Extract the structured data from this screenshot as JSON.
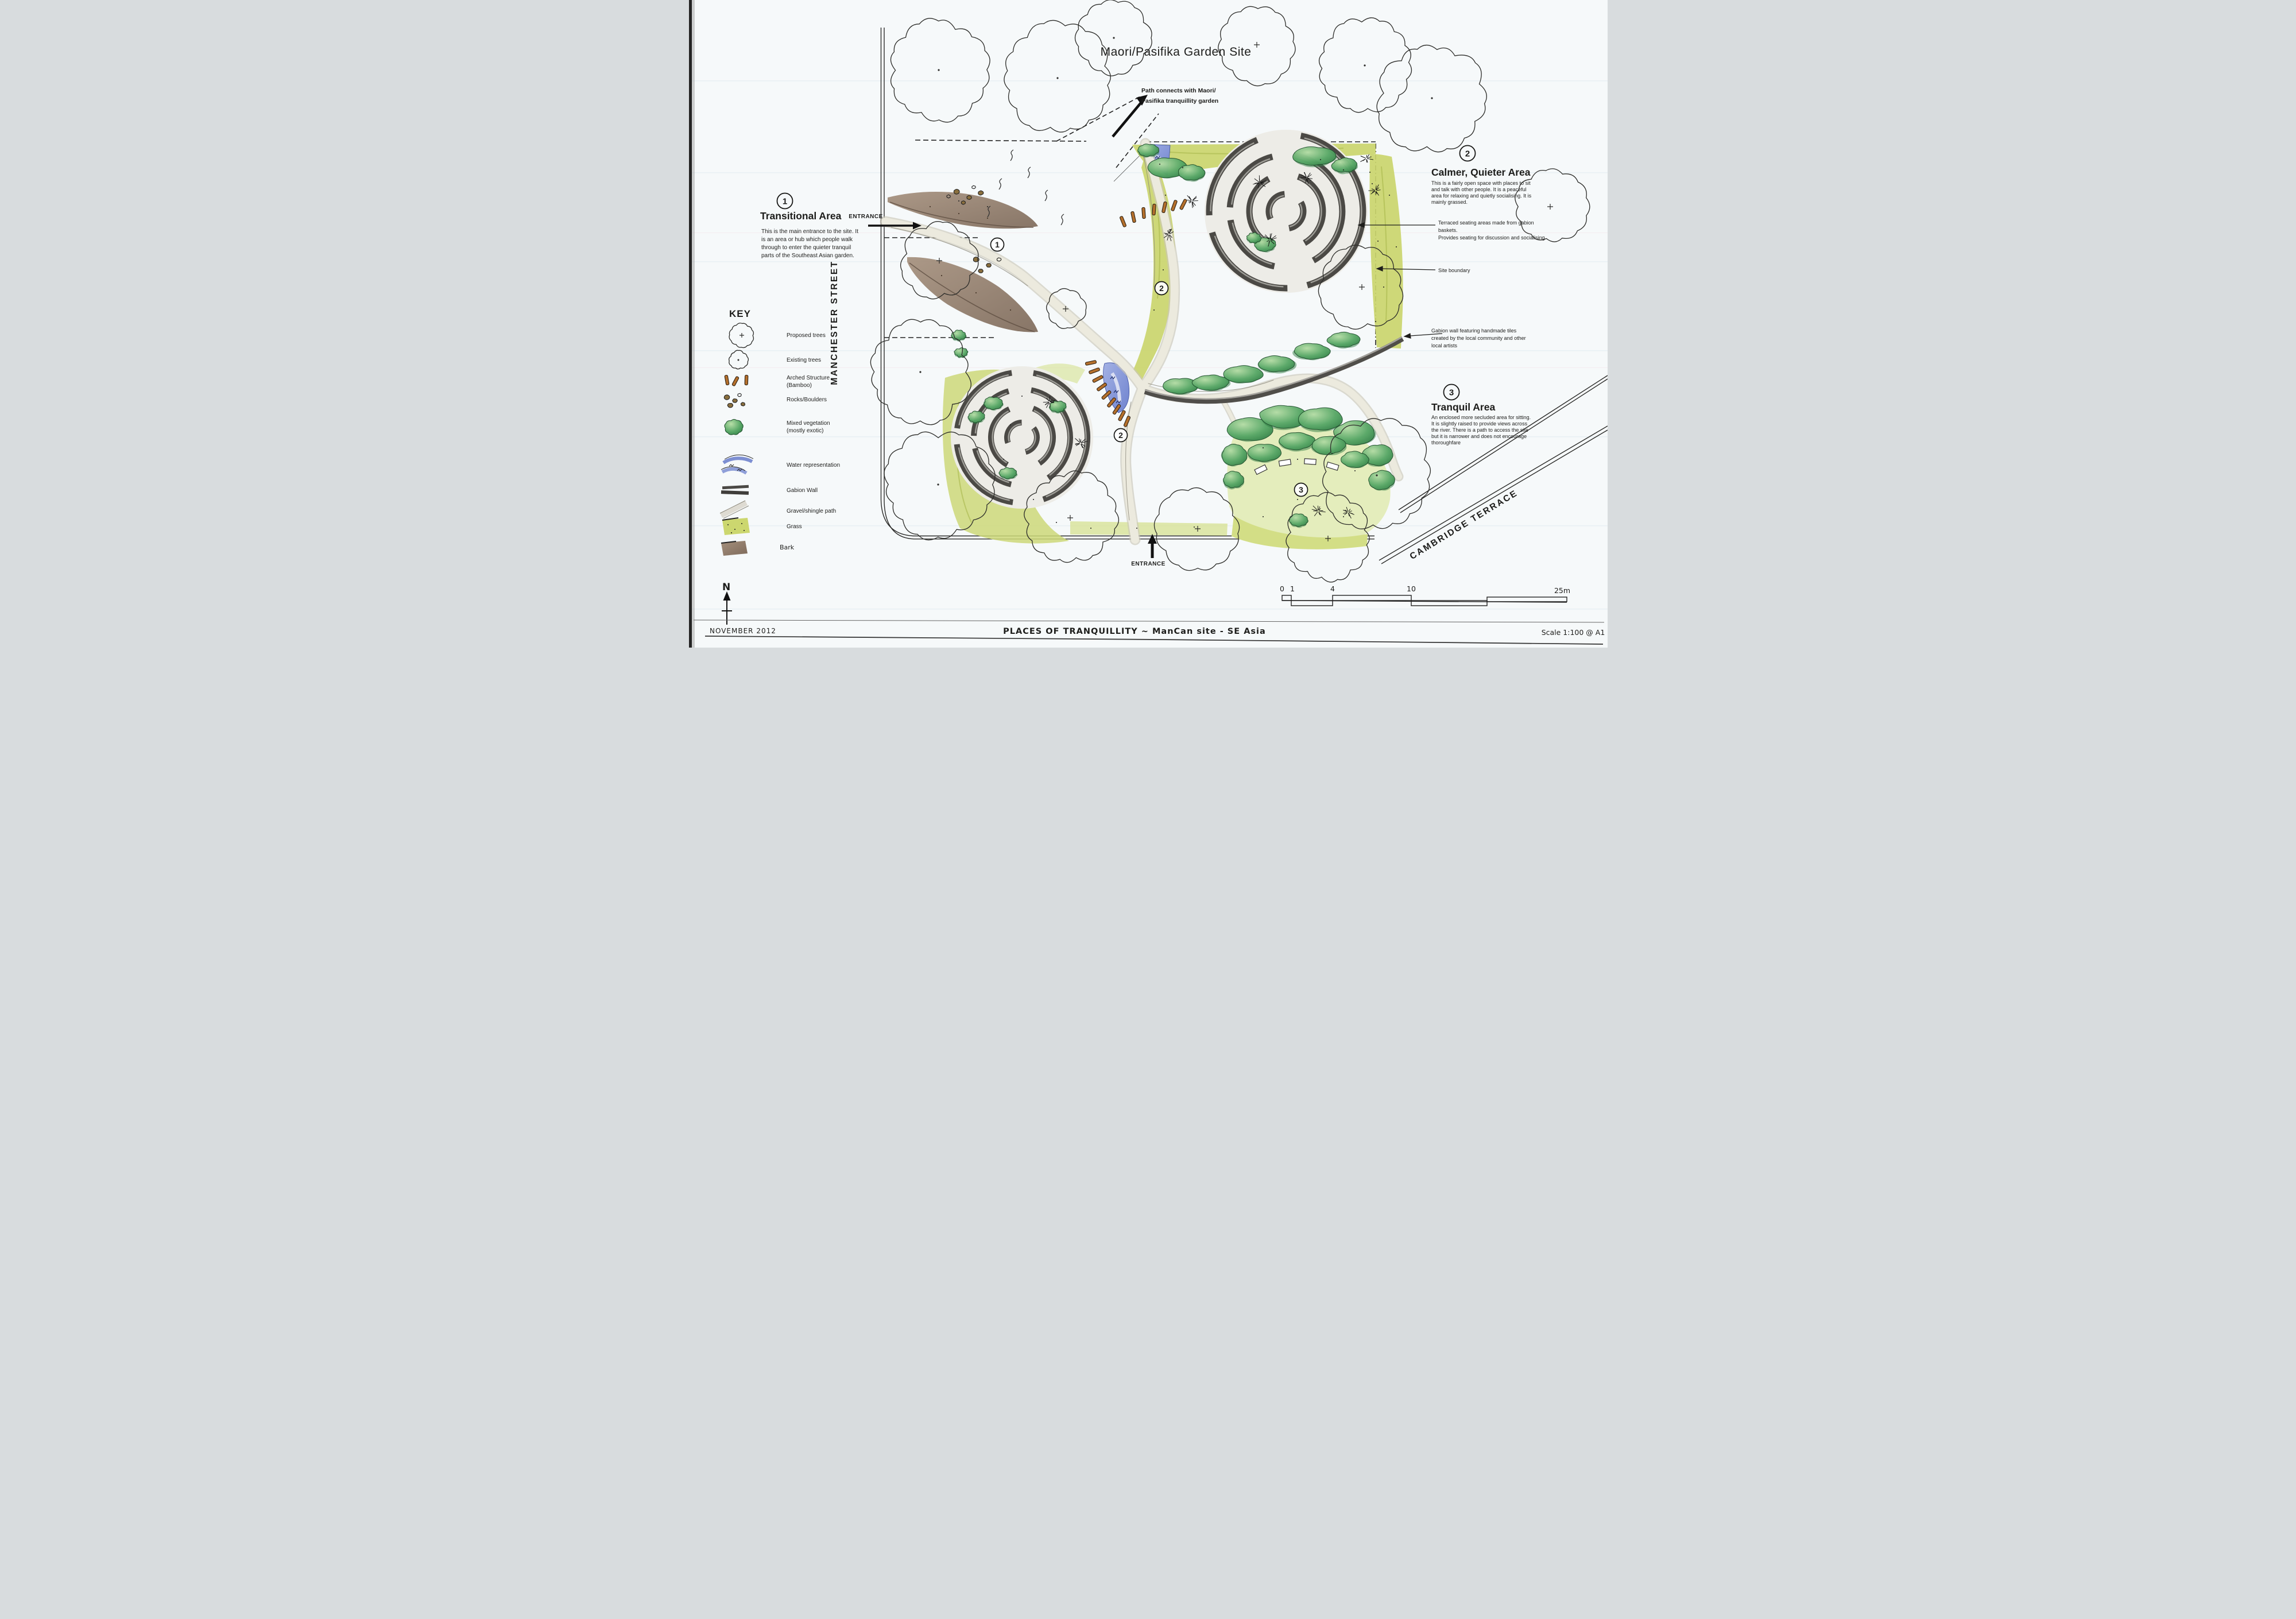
{
  "page": {
    "title": "Maori/Pasifika Garden Site"
  },
  "plan": {
    "path_note": [
      "Path connects with Maori/",
      "Pasifika tranquillity garden"
    ],
    "entrance_left": "ENTRANCE",
    "entrance_bottom": "ENTRANCE",
    "markers": {
      "transitional": "1",
      "calmer_top": "2",
      "calmer_lower": "2",
      "tranquil": "3"
    },
    "streets": {
      "west": "MANCHESTER STREET",
      "southeast": "CAMBRIDGE TERRACE"
    }
  },
  "areas": [
    {
      "number": "1",
      "title": "Transitional Area",
      "body": [
        "This is the main entrance to the site. It",
        "is an area or hub which people walk",
        "through to enter the quieter tranquil",
        "parts of the Southeast Asian garden."
      ]
    },
    {
      "number": "2",
      "title": "Calmer, Quieter Area",
      "body": [
        "This is a fairly open space with places to sit",
        "and talk with other people. It is a peaceful",
        "area for relaxing and quietly socialising. It is",
        "mainly grassed."
      ]
    },
    {
      "number": "3",
      "title": "Tranquil Area",
      "body": [
        "An enclosed more secluded area for sitting.",
        "It is slightly raised to provide views across",
        "the river. There is a path to access the site",
        "but it is narrower and does not encourage",
        "thoroughfare"
      ]
    }
  ],
  "callouts": {
    "terraced_seating": [
      "Terraced seating areas made from gabion",
      "baskets.",
      "Provides seating for discussion and socialising"
    ],
    "site_boundary": "Site boundary",
    "gabion_wall": [
      "Gabion wall featuring handmade tiles",
      "created by the local community and other",
      "local artists"
    ]
  },
  "key": {
    "title": "KEY",
    "items": [
      {
        "label": "Proposed trees"
      },
      {
        "label": "Existing trees"
      },
      {
        "label": "Arched Structure",
        "label2": "(Bamboo)"
      },
      {
        "label": "Rocks/Boulders"
      },
      {
        "label": "Mixed vegetation",
        "label2": "(mostly exotic)"
      },
      {
        "label": "Water representation"
      },
      {
        "label": "Gabion Wall"
      },
      {
        "label": "Gravel/shingle path"
      },
      {
        "label": "Grass"
      },
      {
        "label": "Bark"
      }
    ]
  },
  "compass": {
    "north": "N"
  },
  "scalebar": {
    "labels": [
      "0",
      "1",
      "4",
      "10",
      "25m"
    ]
  },
  "titleblock": {
    "date": "NOVEMBER 2012",
    "title": "PLACES OF TRANQUILLITY ~ ManCan site - SE Asia",
    "scale": "Scale 1:100 @ A1"
  },
  "colors": {
    "paper": "#f6f9fa",
    "ink": "#1d1d1b",
    "grass": "#cad56d",
    "grass_dark": "#a9b84b",
    "veg_dark": "#2d7a42",
    "veg_light": "#b8dfa8",
    "water": "#7d8fd2",
    "bark": "#96816d",
    "gabion": "#4b4945",
    "path": "#eceade",
    "bamboo": "#b5702c"
  }
}
